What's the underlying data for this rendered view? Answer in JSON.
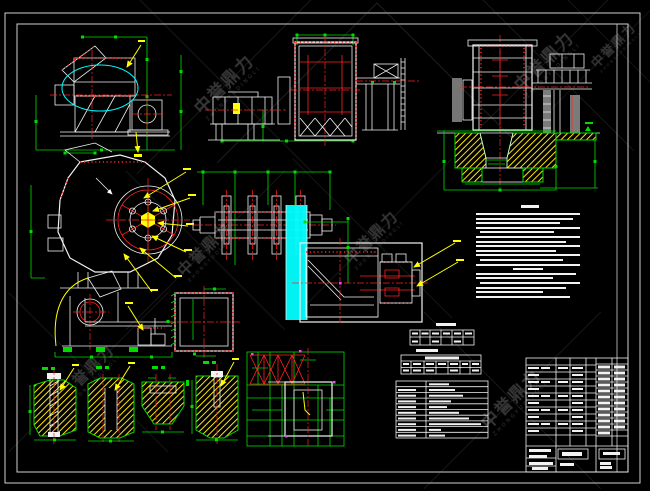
{
  "sheet": {
    "background": "#000000",
    "frame_color": "#cfcfcf"
  },
  "watermark": {
    "text": "中誉鼎力",
    "subtext": "ZHONGYUDINGLI",
    "instances": [
      {
        "x": 225,
        "y": 85,
        "s": 1.0
      },
      {
        "x": 545,
        "y": 62,
        "s": 1.0
      },
      {
        "x": 614,
        "y": 46,
        "s": 0.75
      },
      {
        "x": 205,
        "y": 250,
        "s": 0.9
      },
      {
        "x": 372,
        "y": 238,
        "s": 0.9
      },
      {
        "x": 512,
        "y": 400,
        "s": 1.0
      },
      {
        "x": 88,
        "y": 372,
        "s": 0.9
      }
    ]
  },
  "colors": {
    "bg": "#000000",
    "outline": "#f2f2f2",
    "dimension": "#00dc00",
    "centerline": "#ff2222",
    "hatch": "#ffe600",
    "highlight": "#00ffff",
    "leader": "#ffff00",
    "watermark": "#6a6a6a"
  },
  "notes": {
    "title_width_pct": 16,
    "lines": [
      [
        0,
        96
      ],
      [
        0,
        90
      ],
      [
        0,
        78
      ],
      [
        0,
        96
      ],
      [
        4,
        68
      ],
      [
        0,
        96
      ],
      [
        0,
        83
      ],
      [
        0,
        96
      ],
      [
        0,
        74
      ],
      [
        0,
        96
      ],
      [
        4,
        77
      ],
      [
        0,
        96
      ],
      [
        34,
        28
      ],
      [
        0,
        93
      ],
      [
        0,
        71
      ],
      [
        4,
        92
      ],
      [
        0,
        83
      ],
      [
        0,
        62
      ],
      [
        0,
        87
      ]
    ]
  }
}
